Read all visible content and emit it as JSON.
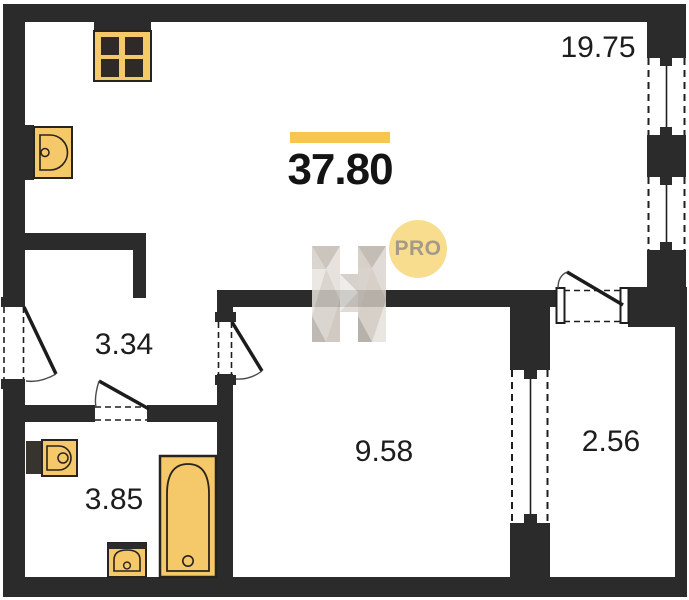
{
  "plan": {
    "total_area": "37.80",
    "badge_label": "PRO",
    "rooms": [
      {
        "id": "living-kitchen",
        "area": "19.75"
      },
      {
        "id": "hallway",
        "area": "3.34"
      },
      {
        "id": "room",
        "area": "9.58"
      },
      {
        "id": "loggia",
        "area": "2.56"
      },
      {
        "id": "bathroom",
        "area": "3.85"
      }
    ],
    "fixtures": [
      "stove",
      "kitchen-sink",
      "washbasin",
      "toilet",
      "bathtub"
    ],
    "colors": {
      "wall": "#2b2b2b",
      "fixture_fill": "#f5c869",
      "fixture_stroke": "#28231d",
      "burner_dark": "#2e2a25",
      "accent_bar": "#f8c550",
      "badge_fill": "#f8dd8f",
      "badge_text": "#a49a89",
      "label_text": "#1d1d1d",
      "watermark_gray": "#d5cec7"
    }
  }
}
